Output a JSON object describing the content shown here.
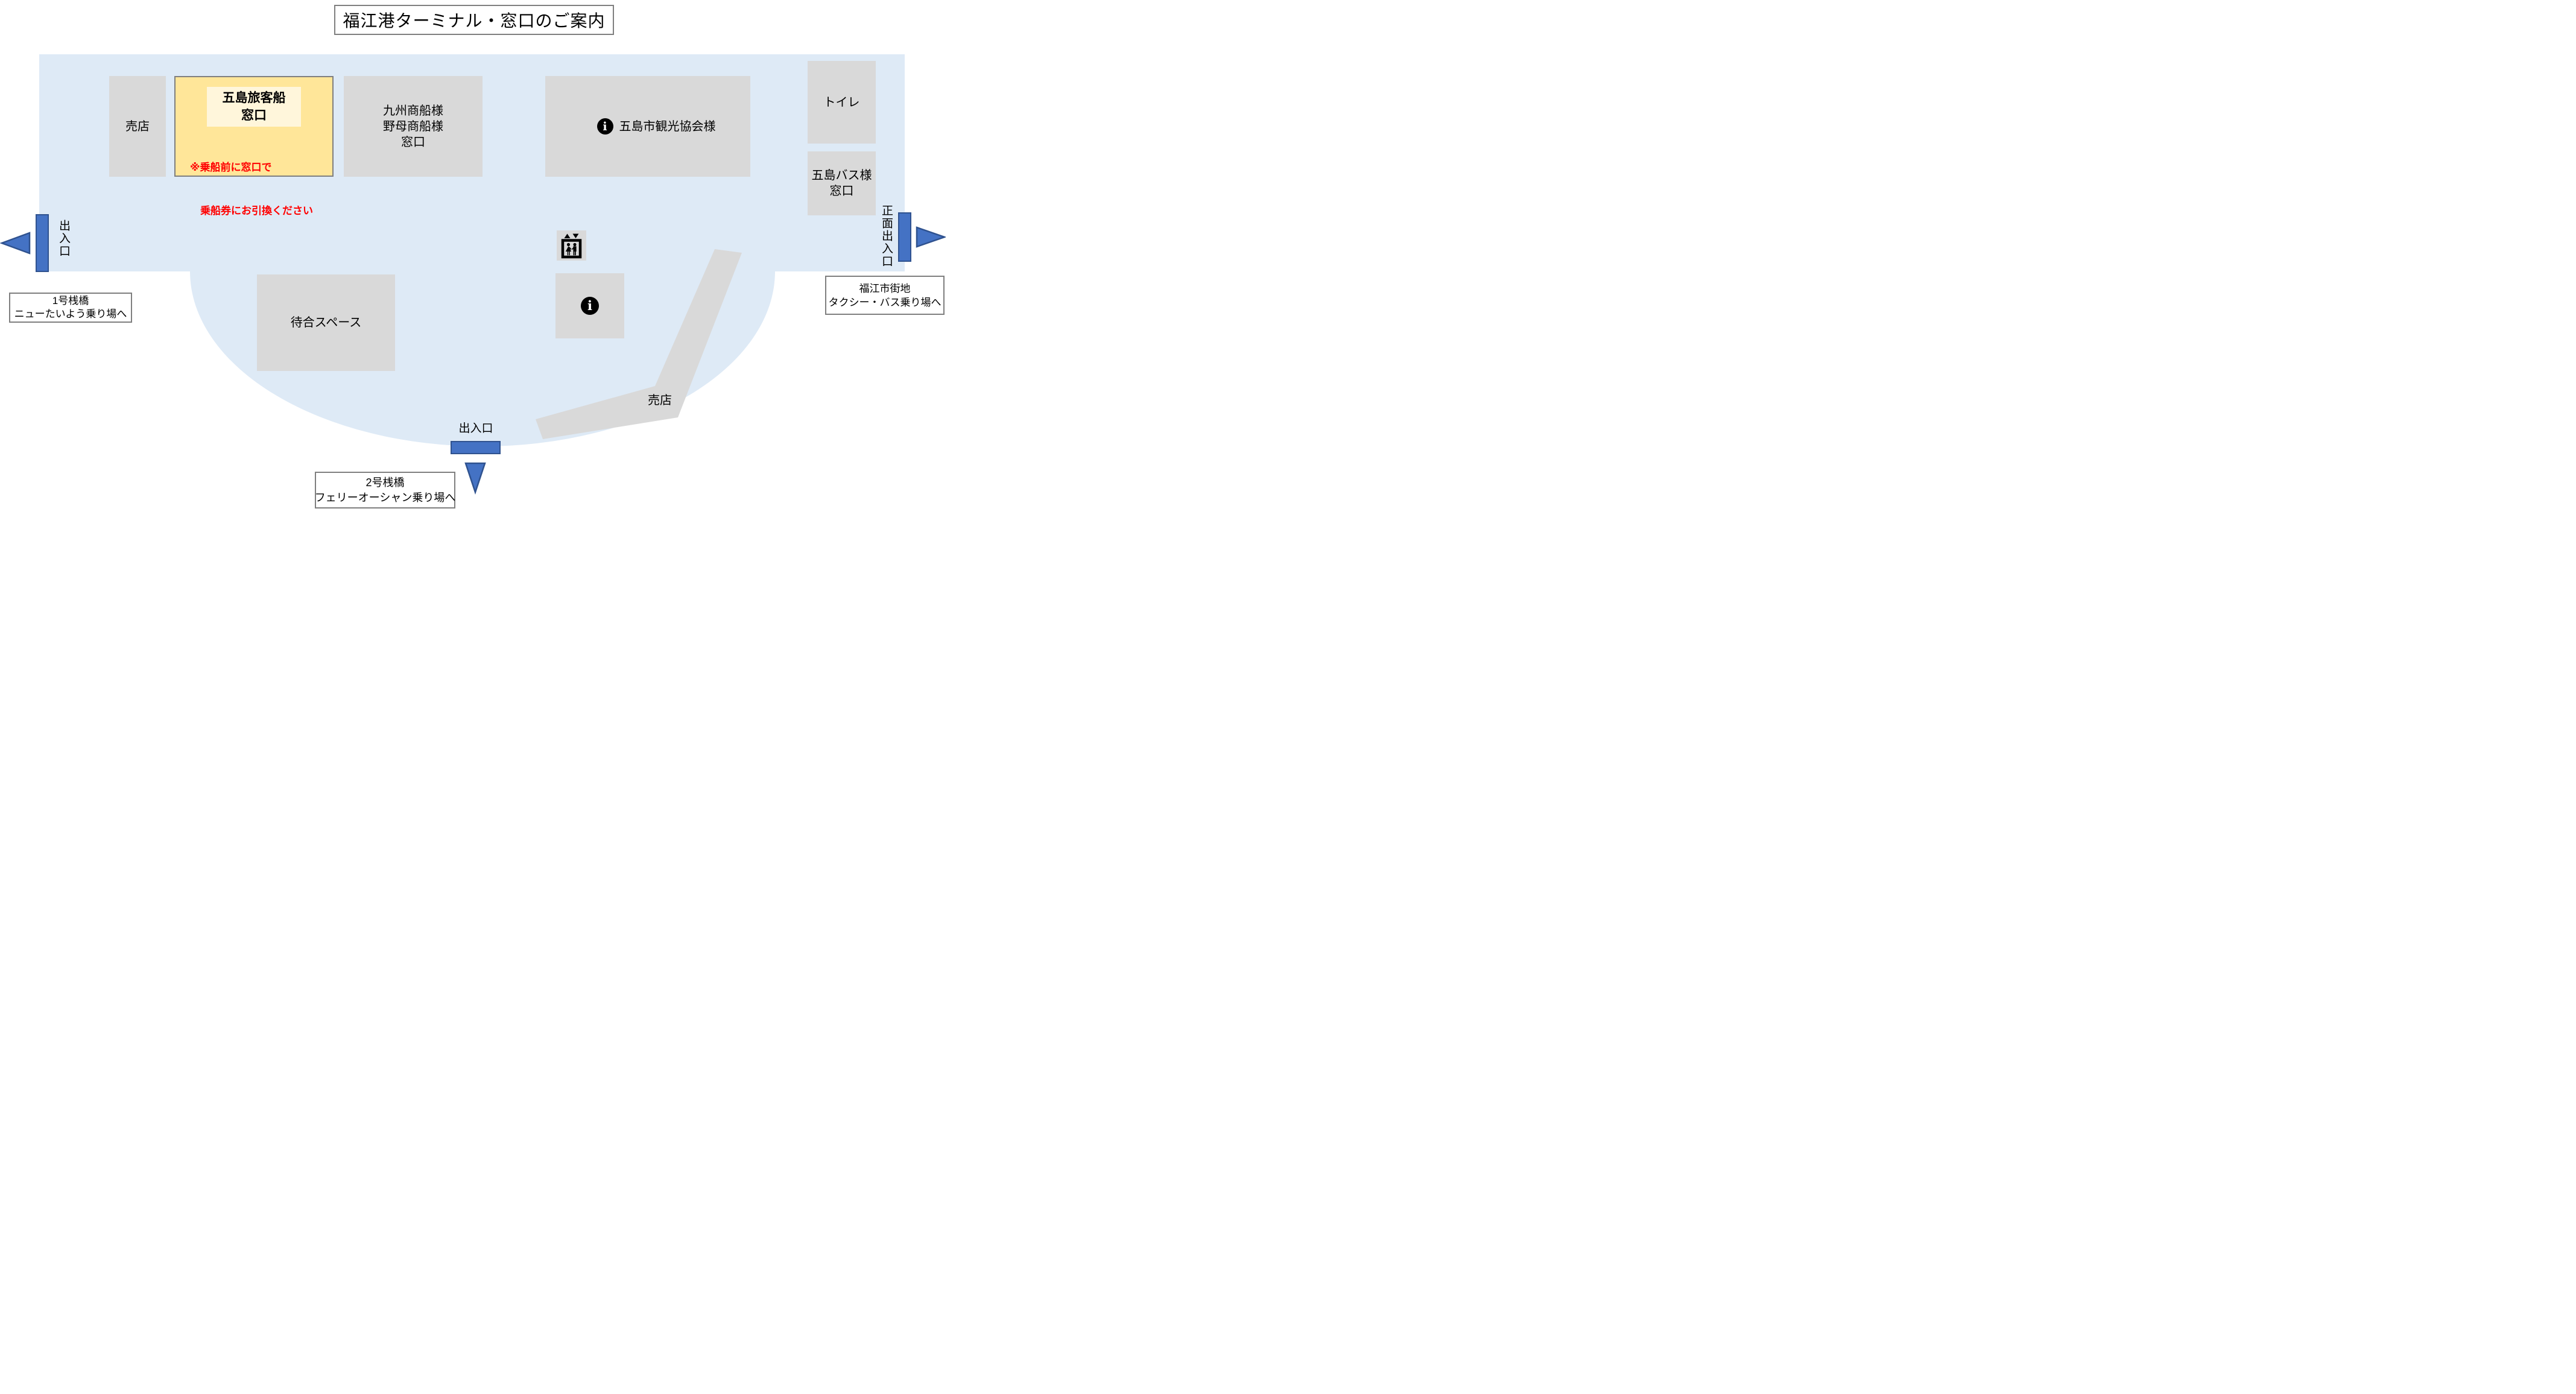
{
  "page": {
    "title": "福江港ターミナル・窓口のご案内"
  },
  "rooms": {
    "shop_left": "売店",
    "goto_ticket": {
      "title_line1": "五島旅客船",
      "title_line2": "窓口",
      "note_line1": "※乗船前に窓口で",
      "note_line2": "　乗船券にお引換ください"
    },
    "kyushu": {
      "line1": "九州商船様",
      "line2": "野母商船様",
      "line3": "窓口"
    },
    "tourism": "五島市観光協会様",
    "toilet": "トイレ",
    "bus": {
      "line1": "五島バス様",
      "line2": "窓口"
    },
    "waiting": "待合スペース",
    "shop_diagonal": "売店"
  },
  "exits": {
    "left": {
      "label": "出入口",
      "dest_line1": "1号桟橋",
      "dest_line2": "ニューたいよう乗り場へ"
    },
    "front": {
      "label": "正面出入口",
      "dest_line1": "福江市街地",
      "dest_line2": "タクシー・バス乗り場へ"
    },
    "pier2": {
      "label": "出入口",
      "dest_line1": "2号桟橋",
      "dest_line2": "フェリーオーシャン乗り場へ"
    }
  },
  "icons": {
    "info_glyph": "i",
    "info_name": "information-pictogram",
    "elevator_name": "elevator-pictogram"
  },
  "colors": {
    "floor": "#DEEAF6",
    "room": "#D9D9D9",
    "highlight": "#FFE699",
    "highlight_inner": "#FFF6DB",
    "note_text": "#FF0000",
    "door": "#4472C4",
    "door_border": "#2F528F",
    "box_border": "#7F7F7F"
  }
}
